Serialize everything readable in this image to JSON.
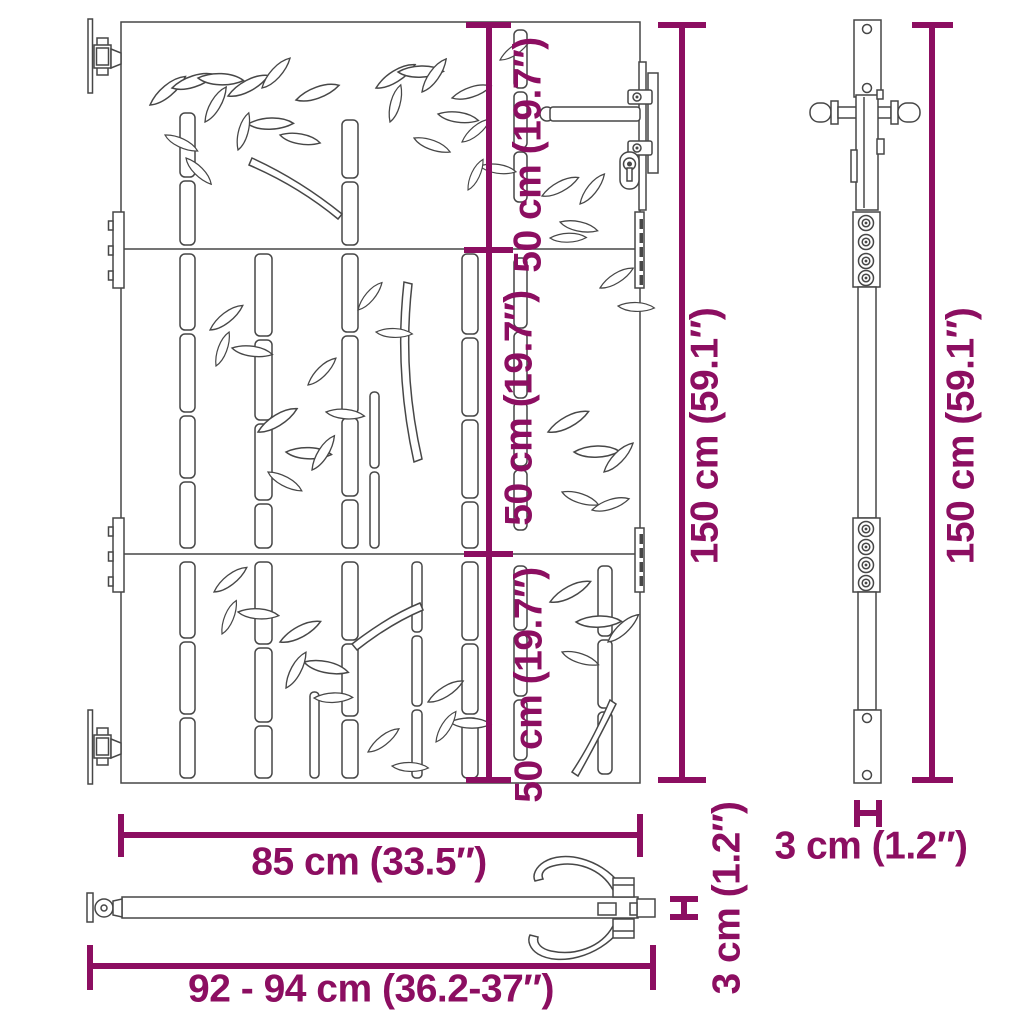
{
  "diagram": {
    "type": "product-dimension-diagram",
    "colors": {
      "accent": "#8c0e61",
      "line": "#474747",
      "bg": "#ffffff"
    },
    "labels": {
      "seg1": "50 cm (19.7″)",
      "seg2": "50 cm (19.7″)",
      "seg3": "50 cm (19.7″)",
      "front_height": "150 cm (59.1″)",
      "side_height": "150 cm (59.1″)",
      "gate_width": "85 cm (33.5″)",
      "total_width": "92 - 94 cm (36.2-37″)",
      "plan_thickness": "3 cm (1.2″)",
      "side_thickness": "3 cm (1.2″)"
    }
  }
}
